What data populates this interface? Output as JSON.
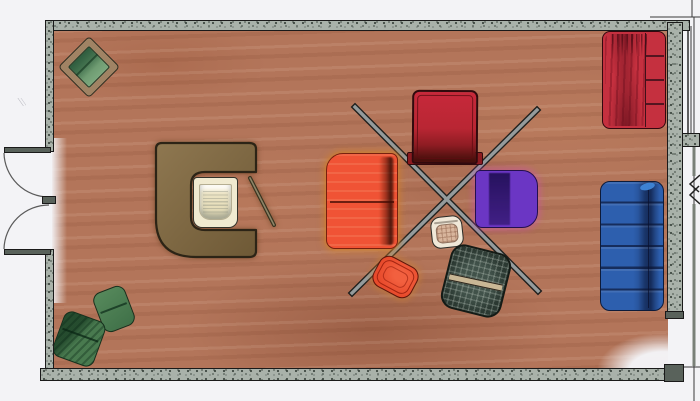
{
  "scene": {
    "kind": "hand-drawn-marker-floor-plan",
    "room_shape": "rectangular",
    "doors": [
      {
        "id": "left-door-upper",
        "swing": "outward-left",
        "hinge": "top-jamb"
      },
      {
        "id": "left-door-lower",
        "swing": "outward-left",
        "hinge": "bottom-jamb"
      }
    ],
    "annotations": [
      {
        "id": "crossed-rods",
        "kind": "two-crossed-poles",
        "color_key": "rod_gray"
      },
      {
        "id": "break-symbol-right-margin",
        "kind": "zigzag-break-lines"
      }
    ]
  },
  "furniture": [
    {
      "id": "green-armchair-top-left",
      "kind": "armchair",
      "placement": "top-left, rotated 45deg",
      "color_key": "green_light"
    },
    {
      "id": "c-shaped-desk",
      "kind": "desk",
      "placement": "center-left, opens right",
      "color_key": "desk_brown"
    },
    {
      "id": "desk-chair",
      "kind": "chair",
      "placement": "inside desk cavity",
      "color_key": "desk_chair"
    },
    {
      "id": "desk-stick",
      "kind": "thin-rod",
      "placement": "right of desk cavity",
      "color_key": "stick"
    },
    {
      "id": "red-rug",
      "kind": "rug-or-table",
      "placement": "top-center-right",
      "color_key": "rug_red"
    },
    {
      "id": "orange-sofa",
      "kind": "two-section-sofa",
      "placement": "center",
      "color_key": "sofa_orange"
    },
    {
      "id": "purple-loveseat",
      "kind": "loveseat",
      "placement": "center-right",
      "color_key": "loveseat_purple"
    },
    {
      "id": "side-stool",
      "kind": "stool",
      "placement": "center, below cross",
      "color_key": "stool_tan"
    },
    {
      "id": "orange-lounge-chair",
      "kind": "lounge-chair",
      "placement": "bottom-center, rotated",
      "color_key": "chair_orange"
    },
    {
      "id": "checkered-lounge-chair",
      "kind": "lounge-chair",
      "placement": "bottom-center-right, rotated",
      "color_key": "checker_base"
    },
    {
      "id": "blue-sofa",
      "kind": "six-cushion-sofa",
      "placement": "right wall",
      "color_key": "sofa_blue"
    },
    {
      "id": "red-sofa",
      "kind": "four-cushion-sofa",
      "placement": "top-right wall",
      "color_key": "sofa_red"
    },
    {
      "id": "green-chair-bottom-a",
      "kind": "armchair",
      "placement": "bottom-left, rotated",
      "color_key": "green_a"
    },
    {
      "id": "green-chair-bottom-b",
      "kind": "armchair",
      "placement": "bottom-left corner, rotated",
      "color_key": "green_b"
    }
  ],
  "palette": {
    "paper": "#f3f3f6",
    "line": "#1a1a1a",
    "wall_fill": "#a9b2aa",
    "wall_speckle": "#3c463f",
    "wall_cap": "#59625b",
    "floor_base": "#b3755a",
    "desk_brown": "#8e7750",
    "desk_brown_deep": "#6e5936",
    "desk_outline": "#2c2416",
    "desk_chair": "#f0ead0",
    "stick": "#45402f",
    "rod_gray": "#949b9c",
    "green_frame": "#a08364",
    "green_light": "#6f9c72",
    "green_dark": "#2e5c3e",
    "green_a": "#578a5c",
    "green_b": "#497a4f",
    "green_outline": "#16301d",
    "rug_red": "#c7293b",
    "rug_deep": "#48100c",
    "rug_outline": "#310a0d",
    "sofa_orange": "#f05335",
    "halo_orange": "#cf8030",
    "loveseat_purple": "#6b36c4",
    "halo_magenta": "#cf4ab8",
    "stool_cream": "#f0e8d8",
    "stool_tan": "#d8b59c",
    "chair_orange": "#e84a2b",
    "checker_base": "#41524a",
    "checker_band": "#c9b795",
    "sofa_blue": "#2d5fae",
    "sofa_blue_outline": "#0d1b3a",
    "sofa_red": "#c5303f"
  }
}
